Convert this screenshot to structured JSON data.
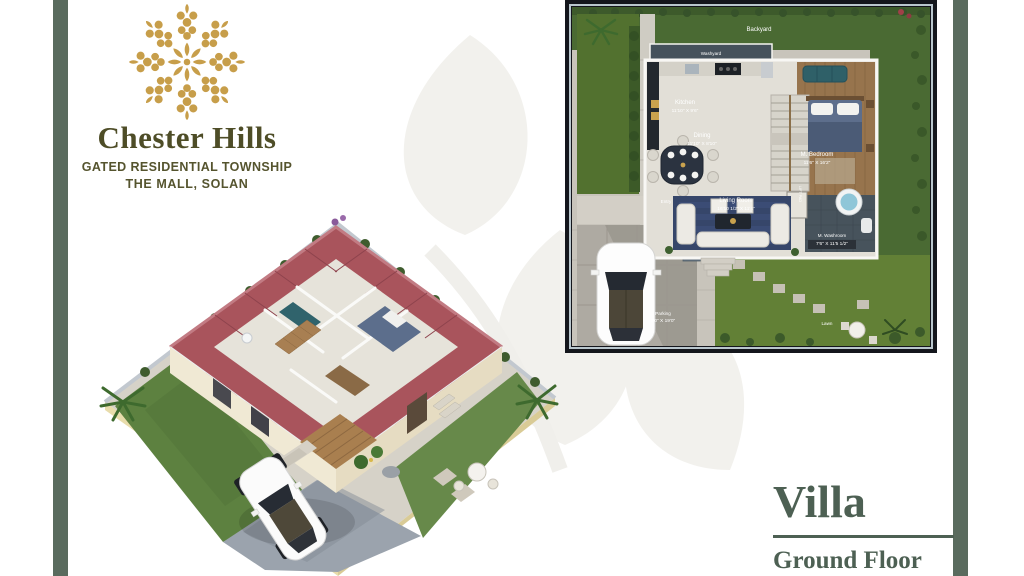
{
  "brand": {
    "name": "Chester Hills",
    "tagline": "GATED RESIDENTIAL TOWNSHIP",
    "location": "THE MALL, SOLAN",
    "logo_gold": "#c79e4a",
    "text_color": "#4e4d27"
  },
  "page": {
    "background": "#ffffff",
    "accent_bar_color": "#5a6b5e"
  },
  "title_block": {
    "title": "Villa",
    "subtitle": "Ground Floor",
    "color": "#4d6053"
  },
  "floor_plan": {
    "border_color": "#14161c",
    "labels": [
      {
        "name": "Backyard",
        "dims": ""
      },
      {
        "name": "Washyard",
        "dims": ""
      },
      {
        "name": "Kitchen",
        "dims": "11'10\" X 9'6\""
      },
      {
        "name": "Dining",
        "dims": "11'10\" X 8'10\""
      },
      {
        "name": "M. Bedroom",
        "dims": "11'6\" X 16'2\""
      },
      {
        "name": "Living Room",
        "dims": "16'10 1/2\" X 11'4\""
      },
      {
        "name": "M. Washroom",
        "dims": "7'6\" X 11'5 1/2\""
      },
      {
        "name": "LIFT PAD",
        "dims": ""
      },
      {
        "name": "Entry",
        "dims": ""
      },
      {
        "name": "Parking",
        "dims": "9'0\" X 19'0\""
      },
      {
        "name": "Lawn",
        "dims": ""
      }
    ]
  }
}
